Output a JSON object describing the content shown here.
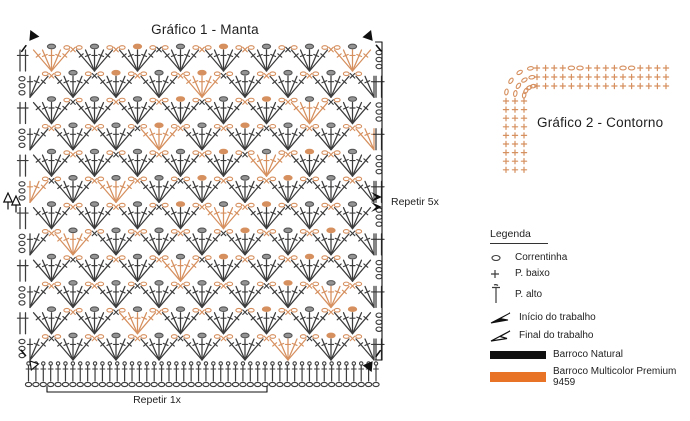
{
  "colors": {
    "symbol_black": "#3c3c3c",
    "symbol_gray": "#949494",
    "symbol_orange": "#d6905f",
    "accent_orange": "#e87327",
    "bar_black": "#101010"
  },
  "grafico1": {
    "title": "Gráfico 1 - Manta",
    "repeat_rows_label": "Repetir 5x",
    "repeat_cols_label": "Repetir 1x",
    "rows": 12,
    "fans_per_row": 8,
    "stitches_per_fan": 5,
    "foundation_stitches": 48
  },
  "grafico2": {
    "title": "Gráfico 2 - Contorno",
    "border_rounds": 3,
    "horizontal_count": 16,
    "vertical_count": 9,
    "top_row_oval_positions": [
      4,
      5,
      10,
      11
    ]
  },
  "legend": {
    "title": "Legenda",
    "items": [
      {
        "icon": "chain-icon",
        "label": "Correntinha"
      },
      {
        "icon": "single-crochet-icon",
        "label": "P. baixo"
      },
      {
        "icon": "tall-stitch-icon",
        "label": "P. alto"
      },
      {
        "icon": "work-start-arrow-icon",
        "label": "Início do trabalho"
      },
      {
        "icon": "work-end-arrow-icon",
        "label": "Final do trabalho"
      },
      {
        "icon": "black-yarn-swatch",
        "label": "Barroco Natural"
      },
      {
        "icon": "orange-yarn-swatch",
        "label": "Barroco Multicolor Premium 9459"
      }
    ]
  }
}
